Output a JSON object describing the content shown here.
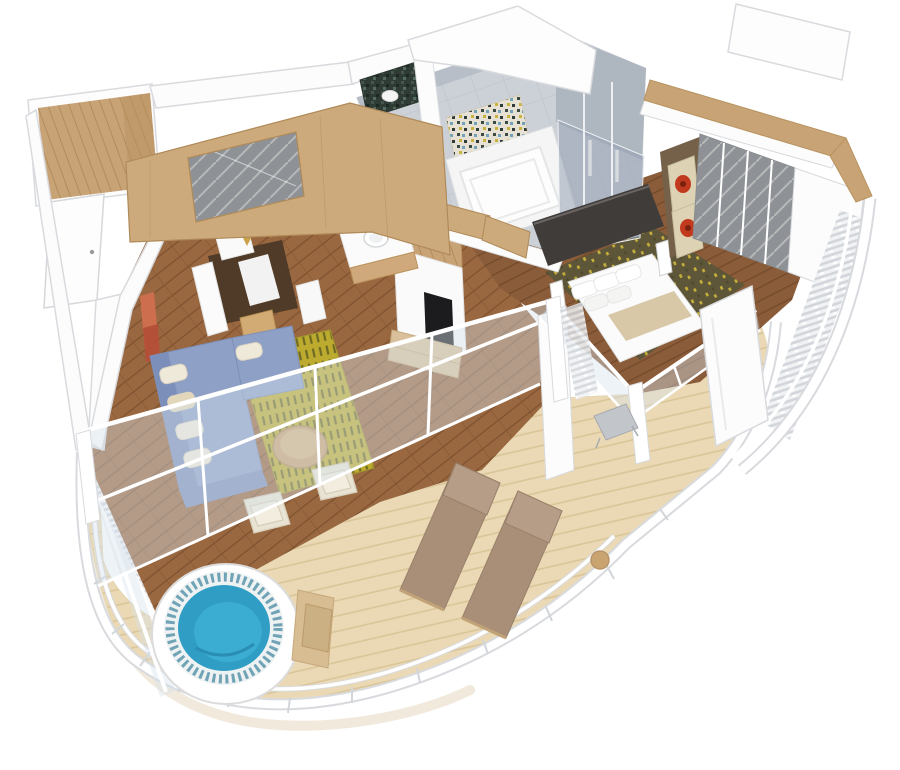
{
  "scene": {
    "kind": "3d-cutaway-floorplan-render",
    "view": "isometric top-down",
    "background": "#ffffff",
    "inventory": [
      "entry-closet",
      "entry-door",
      "ceiling-beams",
      "dining-nook",
      "wall-mirror",
      "pendant-lights",
      "vanity-sink",
      "bathroom",
      "bathtub",
      "mosaic-accent-wall",
      "glass-shower",
      "living-room",
      "sectional-sofa",
      "throw-pillows",
      "area-rug",
      "round-wood-table",
      "cream-armchairs",
      "tv-wall",
      "media-console",
      "bedroom",
      "double-bed",
      "bed-runner",
      "bedside-lamps",
      "flower-artwork",
      "mirrored-wardrobe",
      "patterned-carpet",
      "balcony-deck",
      "glass-balustrade",
      "sheer-curtains",
      "sun-loungers",
      "side-table",
      "hot-tub",
      "tub-steps",
      "curved-railing"
    ]
  },
  "palette": {
    "wall_white": "#fcfcfc",
    "wall_stroke": "#d8dade",
    "wall_shade": "#efefef",
    "wood_living": "#9a6840",
    "wood_living_line": "#7d5130",
    "wood_bedroom": "#8a5c3a",
    "wood_bedroom_line": "#714929",
    "wood_entry": "#c8a376",
    "wood_entry_line": "#b28c5c",
    "beam_wood": "#cdaa7c",
    "beam_edge": "#b08a58",
    "deck_wood": "#ead9b4",
    "deck_line": "#d9c496",
    "deck_shadow": "#eee6d6",
    "tile_gray": "#ccd1d8",
    "tile_line": "#bcc2ca",
    "tile_dark": "#aeb6c0",
    "shower_glass": "rgba(150,160,178,0.55)",
    "glass_tint": "rgba(215,226,235,0.42)",
    "glass_frame": "#ffffff",
    "sofa_blue": "#8fa0c6",
    "sofa_blue_dark": "#7c8fba",
    "pillow_cream": "#efe9da",
    "pillow_beige": "#e2d7ba",
    "rug_yellow": "#bcab2e",
    "rug_dash": "#6e6a24",
    "carpet_olive": "#5c5638",
    "carpet_dot": "#c8b33c",
    "water_blue": "#2f9dc4",
    "water_light": "#3bacd2",
    "water_deep": "#2a8db3",
    "tub_tile": "#6fa3b5",
    "tub_white": "#ffffff",
    "lounge_taupe": "#a98f78",
    "lounge_back": "#b59d87",
    "lounge_frame": "#c2a377",
    "table_wood": "#c9a370",
    "chair_cream": "#e9e3d3",
    "chair_gray": "#c2c5c9",
    "art_red": "#c23a1e",
    "art_canvas": "#ddd3b4",
    "art_panel": "#756049",
    "art_orange": "#cd6f4e",
    "dresser_dark": "#403c3a",
    "tv_black": "#1c1c1e",
    "mirror_gray": "#8e9296",
    "mirror_streak": "#e8e6e2",
    "mosaic_dark": "#2f3b35",
    "curtain_bg": "#f0f1f3",
    "curtain_gray": "#d0d4d9",
    "metal_chrome": "#eef0f3",
    "counter_white": "#fbfbfb",
    "bed_white": "#fbfbfb",
    "runner_beige": "#d8c8a8"
  }
}
